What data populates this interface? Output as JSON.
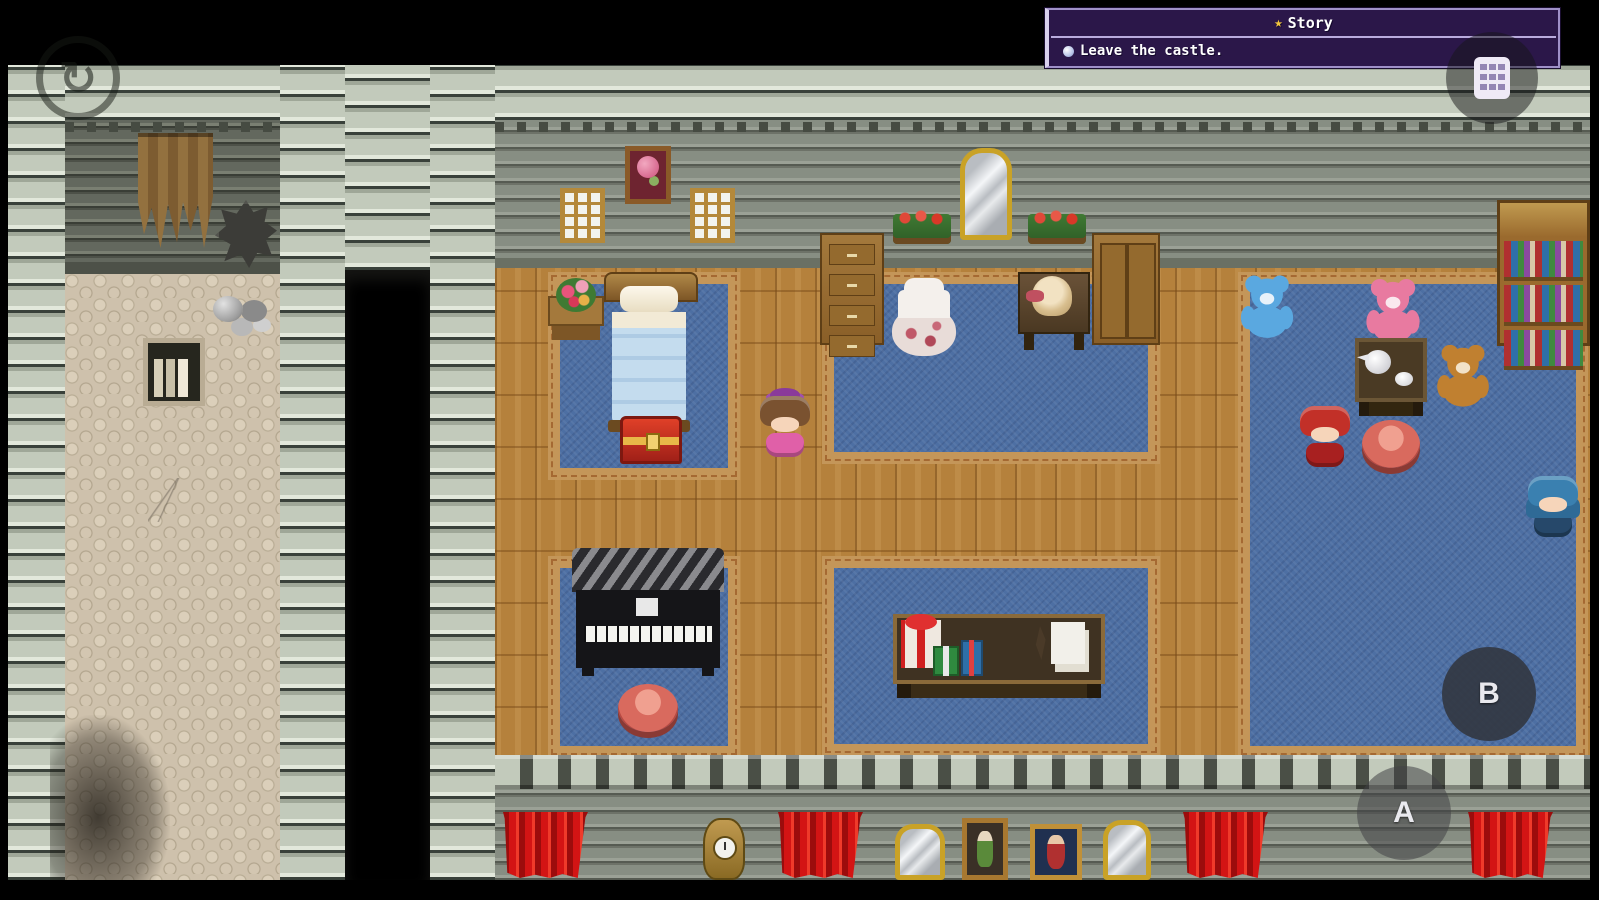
{
  "ui": {
    "quest_panel": {
      "star_icon": "★",
      "title": "Story",
      "objective_bullet": "●",
      "objective_text": "Leave the castle."
    },
    "touch_controls": {
      "a_button_label": "A",
      "b_button_label": "B"
    },
    "icons": {
      "menu_icon": "keypad-grid",
      "skip_icon": "circular-arrow",
      "quest_star_icon": "gold-star",
      "objective_icon": "orb-bullet"
    }
  },
  "scene": {
    "objects": [
      "torn-banner",
      "rubble",
      "rock-pile",
      "wall-book-niche",
      "soot-stain",
      "doorway",
      "flower-painting",
      "window",
      "window",
      "tall-mirror",
      "flower-box",
      "flower-box",
      "tall-dresser",
      "wardrobe",
      "bookshelf",
      "bed",
      "flower-vase-table",
      "treasure-chest",
      "piano",
      "pink-stool",
      "gown-mannequin",
      "doll-desk",
      "gift-table",
      "blue-teddy-bear",
      "pink-teddy-bear",
      "brown-teddy-bear",
      "tea-table",
      "red-stool",
      "red-haired-girl",
      "blue-haired-girl",
      "heroine-girl",
      "red-curtain",
      "red-curtain",
      "red-curtain",
      "red-curtain",
      "wall-clock",
      "small-mirror",
      "portrait-green-lady",
      "portrait-red-figure",
      "small-mirror"
    ]
  },
  "palette": {
    "brick_light": "#c2cabb",
    "wall_gray": "#878e83",
    "corridor_wall": "#63685e",
    "cobble": "#cec1ac",
    "wood": "#b5813c",
    "carpet_blue": "#4d6fa3",
    "carpet_border": "#c49659",
    "curtain_red": "#d31414",
    "panel_purple": "#2b1749",
    "panel_border": "#9f90c8",
    "star_gold": "#f2c53d",
    "gold": "#c9a227"
  }
}
